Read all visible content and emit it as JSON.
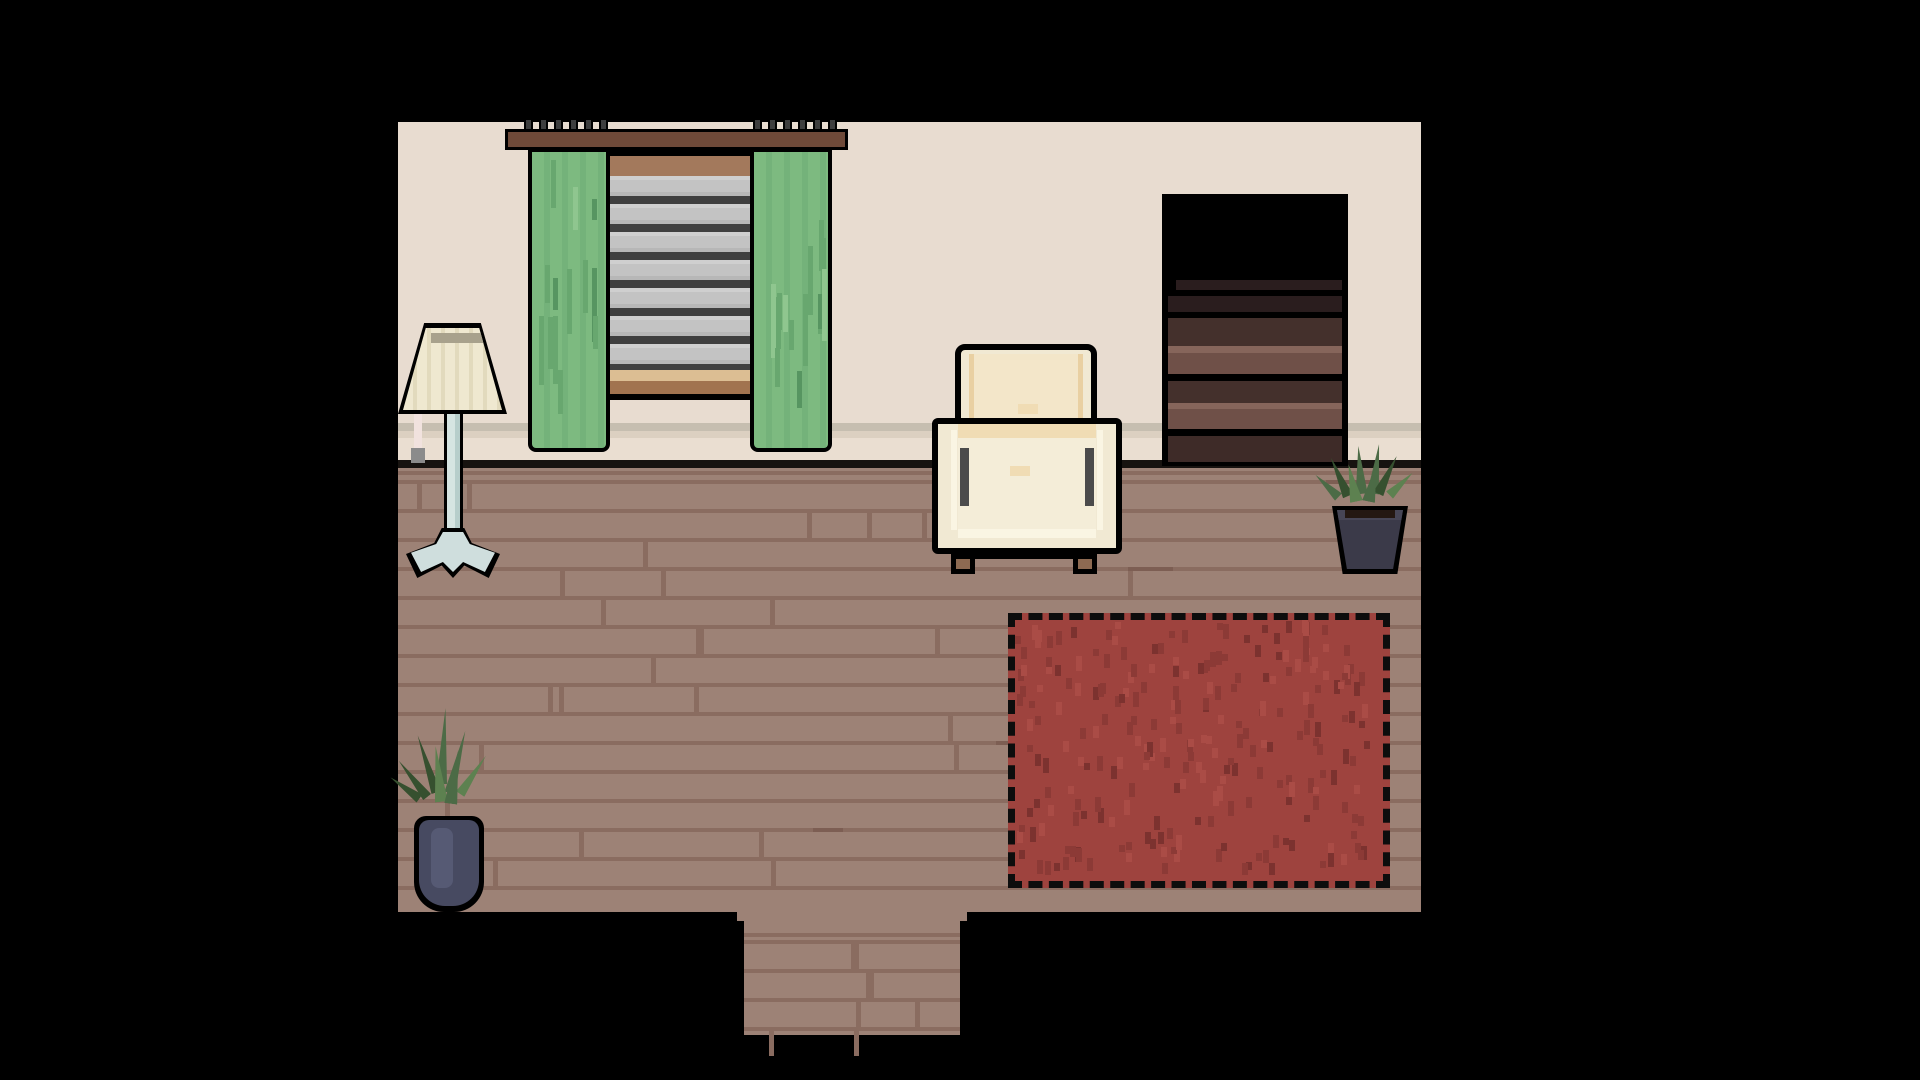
{
  "scene": {
    "title": "Pixel-art living room",
    "objects": {
      "wall": {
        "label": "Cream wall with baseboard"
      },
      "floor": {
        "label": "Wooden plank floor"
      },
      "doorway": {
        "label": "Doorway exit south"
      },
      "curtain_rod": {
        "label": "Curtain rod with hooks"
      },
      "window": {
        "label": "Window with gray striped blinds"
      },
      "curtain_left": {
        "label": "Green curtain left"
      },
      "curtain_right": {
        "label": "Green curtain right"
      },
      "floor_lamp": {
        "label": "Floor lamp with pleated shade"
      },
      "armchair": {
        "label": "Cream armchair"
      },
      "bookshelf": {
        "label": "Dark wooden shelf with drawers"
      },
      "rug": {
        "label": "Red stitched rug"
      },
      "plant_right": {
        "label": "Potted plant in dark pot"
      },
      "plant_left": {
        "label": "Potted plant in blue vase"
      }
    },
    "palette": {
      "background": "#000000",
      "outline": "#000000",
      "wall": "#e8dcd0",
      "baseboard_shadow": "#c6beb0",
      "baseboard_tan": "#dcd0c1",
      "baseboard_light": "#eaded1",
      "floor_edge": "#171310",
      "floor": "#9d8276",
      "floor_seam": "#8a6c60",
      "floor_accent": "#7d5e53",
      "rug": "#9e433e",
      "rug_speckle_dark": "#8c3a36",
      "rug_speckle_deeper": "#7c322f",
      "rug_speckle_light": "#aa4c46",
      "rug_border": "#0d0d0d",
      "curtain": "#7dba80",
      "curtain_shade": "#74b27a",
      "curtain_dark": "#68a76f",
      "curtain_darker": "#579561",
      "rod": "#6f4a39",
      "hook": "#3e3e3e",
      "window_top_bar": "#a3795c",
      "blind_light": "#c3c3c3",
      "blind_lighter": "#cfcfcf",
      "blind_shadow": "#b7b7b7",
      "blind_dark": "#3f3f3f",
      "sill_tan": "#dcbe93",
      "sill_brown": "#a1734f",
      "chair_body": "#f1e9d3",
      "chair_cushion": "#f3e6c9",
      "chair_cushion_edge": "#e9d0a2",
      "chair_band": "#f0dcb4",
      "chair_seat": "#f4edd8",
      "chair_highlight": "#faf5e3",
      "chair_accent": "#4b4b4b",
      "chair_foot": "#8d6a52",
      "lamp_shade": "#efe8d0",
      "lamp_pleat": "#e2dabd",
      "lamp_opening": "#a8a18c",
      "lamp_stem": "#d6e5e2",
      "lamp_stem_shadow": "#b7cecb",
      "lamp_base": "#cfdedd",
      "cord": "#f1e2de",
      "plug": "#8b8b8b",
      "shelf_body": "#000000",
      "shelf_band_dark": "#2a1d1e",
      "shelf_band_mid": "#44302c",
      "shelf_band_light": "#86655b",
      "shelf_band_brown": "#6f5048",
      "shelf_band_deep": "#3e2b28",
      "pot_left": "#474a61",
      "pot_left_light": "#565a74",
      "pot_right": "#3b3a49",
      "pot_right_rim": "#474656",
      "soil": "#241812",
      "leaf": "#4c6b46",
      "leaf_dark": "#36502f",
      "leaf_light": "#5d8150"
    }
  }
}
